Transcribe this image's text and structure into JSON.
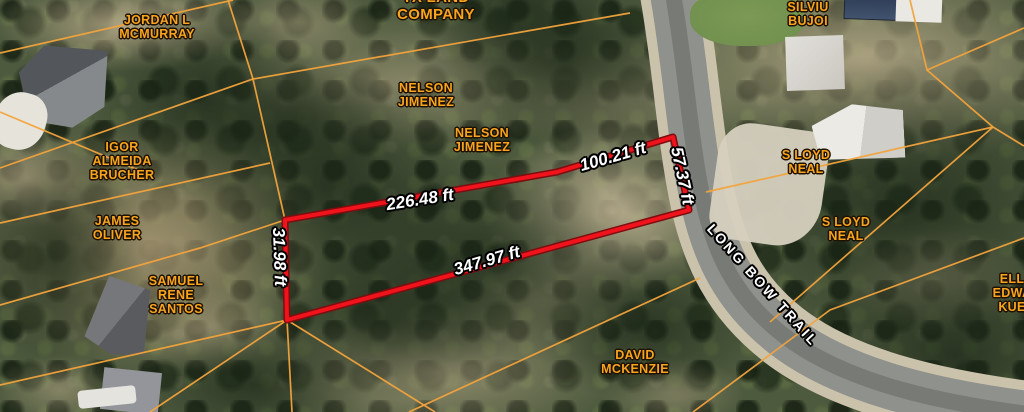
{
  "map": {
    "colors": {
      "parcel_line": "#f2a33c",
      "highlight_outline": "#f0131b",
      "owner_text": "#f8a41e",
      "measure_text": "#ffffff",
      "road_label_text": "#ffffff",
      "road_asphalt": "#8f918d",
      "road_shoulder": "#cbc2ab"
    },
    "owners": [
      {
        "lines": [
          "JORDAN L",
          "MCMURRAY"
        ],
        "x": 157,
        "y": 27
      },
      {
        "lines": [
          "TX LAND",
          "COMPANY"
        ],
        "x": 436,
        "y": 7,
        "size": 15
      },
      {
        "lines": [
          "SILVIU",
          "BUJOI"
        ],
        "x": 808,
        "y": 14
      },
      {
        "lines": [
          "NELSON",
          "JIMENEZ"
        ],
        "x": 426,
        "y": 95
      },
      {
        "lines": [
          "NELSON",
          "JIMENEZ"
        ],
        "x": 482,
        "y": 140
      },
      {
        "lines": [
          "IGOR",
          "ALMEIDA",
          "BRUCHER"
        ],
        "x": 122,
        "y": 161
      },
      {
        "lines": [
          "S LOYD",
          "NEAL"
        ],
        "x": 806,
        "y": 162
      },
      {
        "lines": [
          "S LOYD",
          "NEAL"
        ],
        "x": 846,
        "y": 229
      },
      {
        "lines": [
          "JAMES",
          "OLIVER"
        ],
        "x": 117,
        "y": 228
      },
      {
        "lines": [
          "SAMUEL",
          "RENE",
          "SANTOS"
        ],
        "x": 176,
        "y": 295
      },
      {
        "lines": [
          "DAVID",
          "MCKENZIE"
        ],
        "x": 635,
        "y": 362
      },
      {
        "lines": [
          "ELL",
          "EDWA",
          "KUE"
        ],
        "x": 1012,
        "y": 293
      }
    ],
    "measurements": [
      {
        "text": "226.48 ft",
        "x": 420,
        "y": 200,
        "rotate": -9
      },
      {
        "text": "100.21 ft",
        "x": 613,
        "y": 157,
        "rotate": -16
      },
      {
        "text": "57.37 ft",
        "x": 682,
        "y": 176,
        "rotate": 78
      },
      {
        "text": "31.98 ft",
        "x": 279,
        "y": 257,
        "rotate": 88
      },
      {
        "text": "347.97 ft",
        "x": 487,
        "y": 261,
        "rotate": -16
      }
    ],
    "road_label": {
      "text": "LONG BOW TRAIL",
      "x": 763,
      "y": 285,
      "rotate": 48
    },
    "highlight_parcel": {
      "points": [
        [
          285,
          220
        ],
        [
          557,
          172
        ],
        [
          673,
          137
        ],
        [
          689,
          210
        ],
        [
          287,
          320
        ]
      ],
      "closed": true
    },
    "parcel_lines": [
      [
        [
          0,
          53
        ],
        [
          233,
          0
        ]
      ],
      [
        [
          228,
          0
        ],
        [
          253,
          79
        ],
        [
          285,
          220
        ]
      ],
      [
        [
          0,
          168
        ],
        [
          253,
          79
        ],
        [
          630,
          13
        ]
      ],
      [
        [
          0,
          112
        ],
        [
          150,
          175
        ]
      ],
      [
        [
          0,
          223
        ],
        [
          270,
          163
        ]
      ],
      [
        [
          0,
          305
        ],
        [
          200,
          248
        ],
        [
          285,
          220
        ]
      ],
      [
        [
          287,
          320
        ],
        [
          0,
          385
        ]
      ],
      [
        [
          287,
          320
        ],
        [
          150,
          412
        ]
      ],
      [
        [
          287,
          320
        ],
        [
          292,
          412
        ]
      ],
      [
        [
          287,
          320
        ],
        [
          435,
          412
        ]
      ],
      [
        [
          409,
          412
        ],
        [
          700,
          278
        ]
      ],
      [
        [
          770,
          322
        ],
        [
          993,
          127
        ]
      ],
      [
        [
          706,
          192
        ],
        [
          993,
          127
        ]
      ],
      [
        [
          993,
          127
        ],
        [
          1024,
          146
        ]
      ],
      [
        [
          910,
          0
        ],
        [
          927,
          70
        ],
        [
          993,
          127
        ]
      ],
      [
        [
          927,
          70
        ],
        [
          1024,
          28
        ]
      ],
      [
        [
          693,
          412
        ],
        [
          830,
          310
        ],
        [
          1024,
          238
        ]
      ]
    ],
    "road_path": "M 672,-12 C 685,60 688,120 700,185 C 712,252 735,300 790,340 C 850,383 940,403 1035,415"
  }
}
